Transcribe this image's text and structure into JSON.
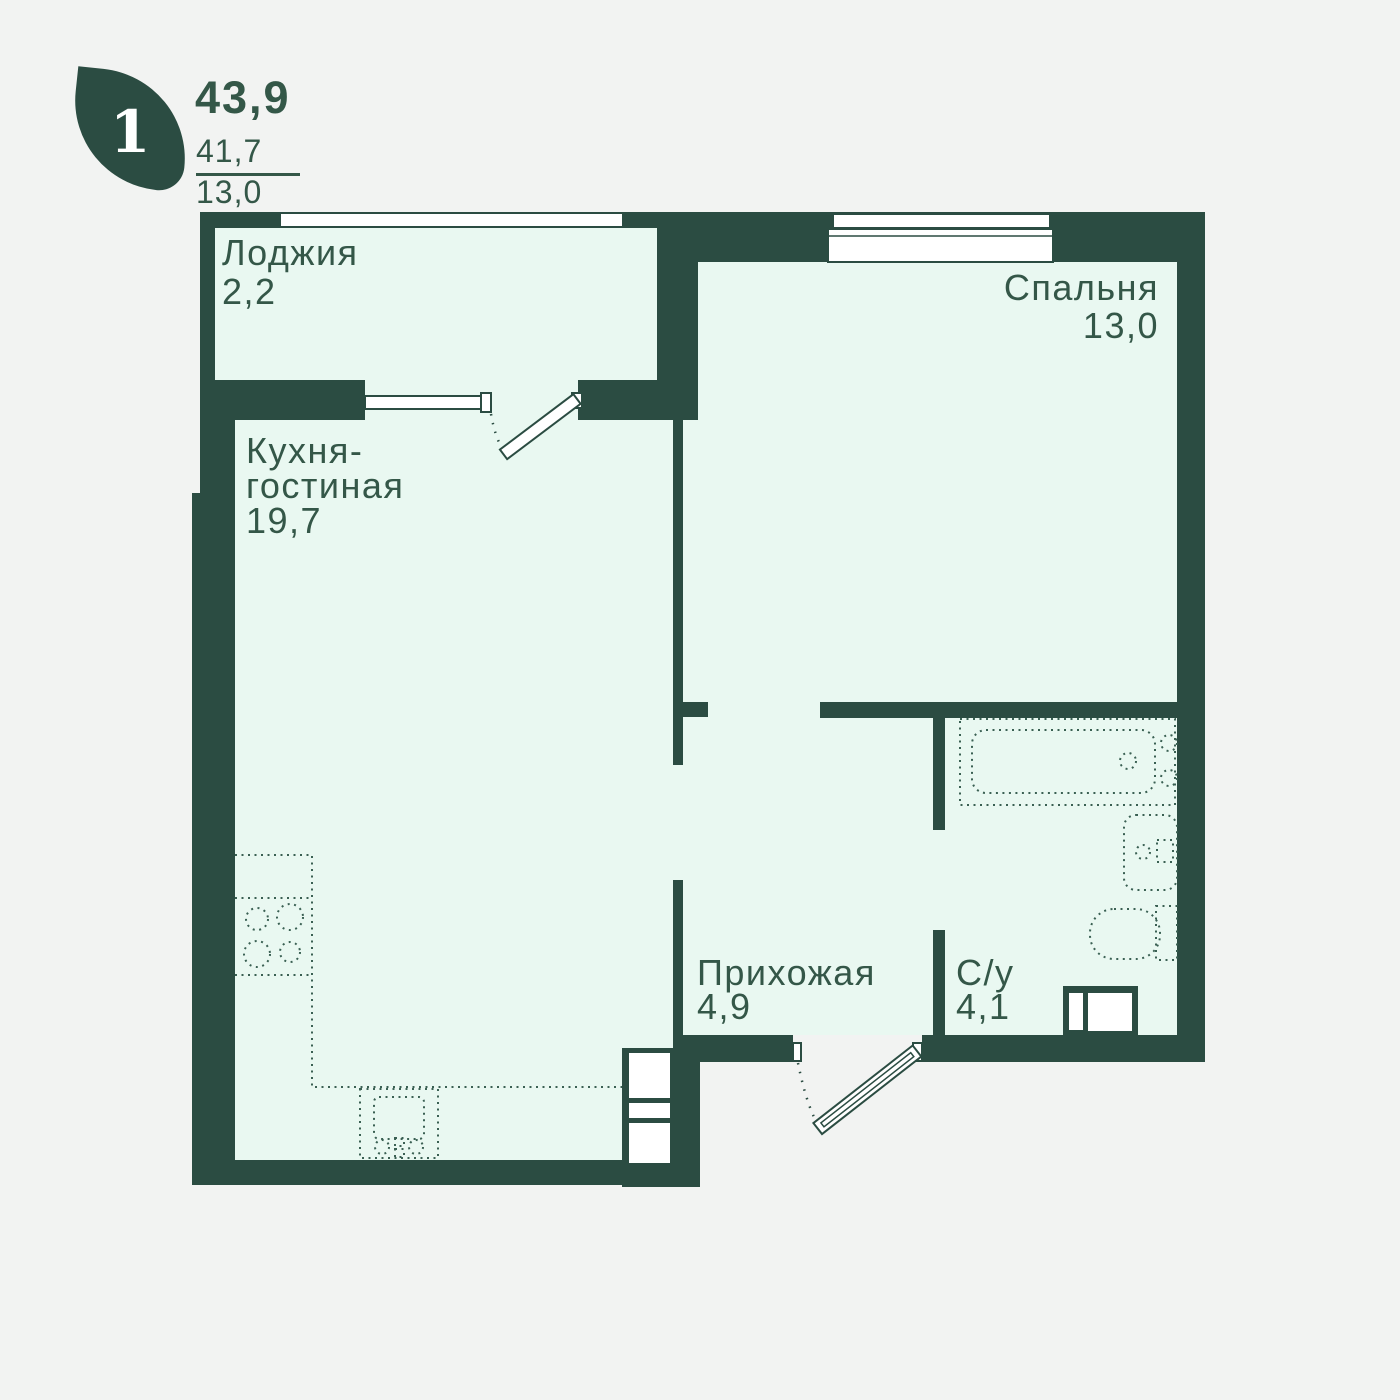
{
  "header": {
    "rooms_count": "1",
    "total_area": "43,9",
    "living_area": "41,7",
    "kitchen_area": "13,0"
  },
  "rooms": {
    "loggia": {
      "name": "Лоджия",
      "area": "2,2"
    },
    "kitchen_living": {
      "name_line1": "Кухня-",
      "name_line2": "гостиная",
      "area": "19,7"
    },
    "bedroom": {
      "name": "Спальня",
      "area": "13,0"
    },
    "hallway": {
      "name": "Прихожая",
      "area": "4,9"
    },
    "bathroom": {
      "name": "С/у",
      "area": "4,1"
    }
  },
  "icons": {
    "logo": "leaf-icon",
    "fixtures": [
      "bathtub-icon",
      "wash-basin-icon",
      "toilet-icon",
      "stove-icon",
      "kitchen-sink-icon",
      "vent-duct-icon",
      "shaft-icon"
    ]
  },
  "colors": {
    "wall": "#2B4C42",
    "room_fill": "#E9F8F1",
    "background": "#F2F3F2",
    "window": "#FFFFFF",
    "text": "#345748"
  }
}
